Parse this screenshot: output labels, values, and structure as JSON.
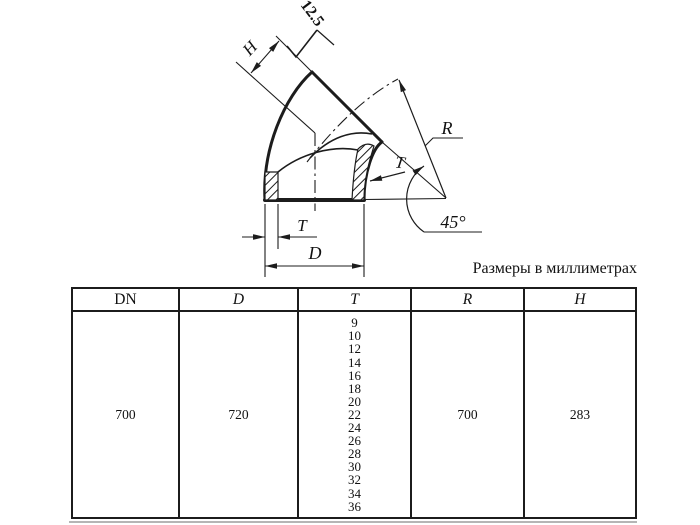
{
  "page": {
    "units_note": "Размеры в миллиметрах"
  },
  "drawing": {
    "description": "Sectioned 45-degree pipe elbow with dimension callouts",
    "labels": {
      "roughness_value": "12.5",
      "center_to_end": "H",
      "bend_radius": "R",
      "wall_thickness_leader": "T",
      "bend_angle": "45°",
      "wall_thickness_dim": "T",
      "outer_diameter_dim": "D"
    }
  },
  "table": {
    "headers": [
      "DN",
      "D",
      "T",
      "R",
      "H"
    ],
    "row": {
      "dn": "700",
      "d": "720",
      "t_values": [
        "9",
        "10",
        "12",
        "14",
        "16",
        "18",
        "20",
        "22",
        "24",
        "26",
        "28",
        "30",
        "32",
        "34",
        "36"
      ],
      "r": "700",
      "h": "283"
    }
  },
  "colors": {
    "ink": "#1c1c1c",
    "paper": "#ffffff"
  }
}
